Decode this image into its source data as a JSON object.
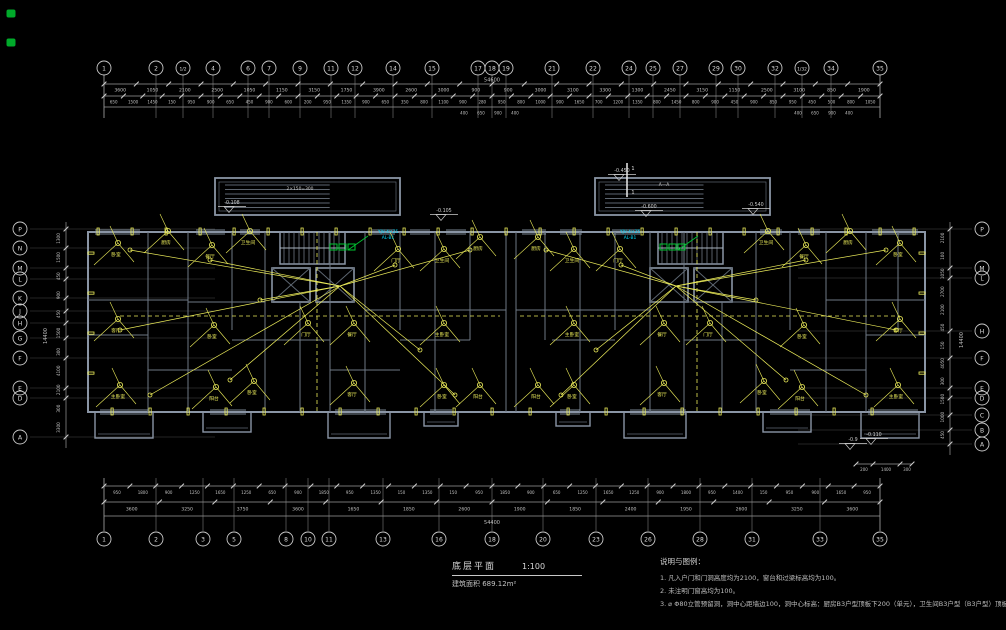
{
  "drawing": {
    "title": "底层平面",
    "scale": "1:100",
    "area_note": "建筑面积 689.12m²",
    "total_dim_top": "54600",
    "total_dim_bottom": "54400",
    "total_dim_left": "14400",
    "total_dim_right": "14400",
    "grid": {
      "top": [
        {
          "x": 104,
          "label": "1"
        },
        {
          "x": 156,
          "label": "2"
        },
        {
          "x": 183,
          "label": "1/2"
        },
        {
          "x": 213,
          "label": "4"
        },
        {
          "x": 248,
          "label": "6"
        },
        {
          "x": 269,
          "label": "7"
        },
        {
          "x": 300,
          "label": "9"
        },
        {
          "x": 331,
          "label": "11"
        },
        {
          "x": 355,
          "label": "12"
        },
        {
          "x": 393,
          "label": "14"
        },
        {
          "x": 432,
          "label": "15"
        },
        {
          "x": 478,
          "label": "17"
        },
        {
          "x": 492,
          "label": "18"
        },
        {
          "x": 506,
          "label": "19"
        },
        {
          "x": 552,
          "label": "21"
        },
        {
          "x": 593,
          "label": "22"
        },
        {
          "x": 629,
          "label": "24"
        },
        {
          "x": 653,
          "label": "25"
        },
        {
          "x": 680,
          "label": "27"
        },
        {
          "x": 716,
          "label": "29"
        },
        {
          "x": 738,
          "label": "30"
        },
        {
          "x": 775,
          "label": "32"
        },
        {
          "x": 802,
          "label": "1/32"
        },
        {
          "x": 831,
          "label": "34"
        },
        {
          "x": 880,
          "label": "35"
        }
      ],
      "bottom": [
        {
          "x": 104,
          "label": "1"
        },
        {
          "x": 156,
          "label": "2"
        },
        {
          "x": 203,
          "label": "3"
        },
        {
          "x": 234,
          "label": "5"
        },
        {
          "x": 286,
          "label": "8"
        },
        {
          "x": 308,
          "label": "10"
        },
        {
          "x": 329,
          "label": "11"
        },
        {
          "x": 383,
          "label": "13"
        },
        {
          "x": 439,
          "label": "16"
        },
        {
          "x": 492,
          "label": "18"
        },
        {
          "x": 543,
          "label": "20"
        },
        {
          "x": 596,
          "label": "23"
        },
        {
          "x": 648,
          "label": "26"
        },
        {
          "x": 700,
          "label": "28"
        },
        {
          "x": 752,
          "label": "31"
        },
        {
          "x": 820,
          "label": "33"
        },
        {
          "x": 880,
          "label": "35"
        }
      ],
      "left": [
        {
          "y": 229,
          "label": "P"
        },
        {
          "y": 248,
          "label": "N"
        },
        {
          "y": 268,
          "label": "M"
        },
        {
          "y": 279,
          "label": "L"
        },
        {
          "y": 298,
          "label": "K"
        },
        {
          "y": 311,
          "label": "J"
        },
        {
          "y": 323,
          "label": "H"
        },
        {
          "y": 338,
          "label": "G"
        },
        {
          "y": 358,
          "label": "F"
        },
        {
          "y": 388,
          "label": "E"
        },
        {
          "y": 398,
          "label": "D"
        },
        {
          "y": 437,
          "label": "A"
        }
      ],
      "right": [
        {
          "y": 229,
          "label": "P"
        },
        {
          "y": 268,
          "label": "M"
        },
        {
          "y": 278,
          "label": "L"
        },
        {
          "y": 331,
          "label": "H"
        },
        {
          "y": 358,
          "label": "F"
        },
        {
          "y": 388,
          "label": "E"
        },
        {
          "y": 398,
          "label": "D"
        },
        {
          "y": 415,
          "label": "C"
        },
        {
          "y": 430,
          "label": "B"
        },
        {
          "y": 444,
          "label": "A"
        }
      ]
    },
    "dims": {
      "top_major": [
        3600,
        1050,
        2100,
        2500,
        1050,
        1150,
        3150,
        1750,
        3900,
        2600,
        3000,
        900,
        900,
        3000,
        3100,
        3300,
        1300,
        2450,
        3150,
        1150,
        2500,
        3100,
        850,
        1900
      ],
      "top_minor": [
        650,
        1500,
        1450,
        150,
        950,
        900,
        650,
        450,
        900,
        600,
        200,
        950,
        1350,
        900,
        650,
        350,
        800,
        1100,
        900,
        280,
        950,
        800,
        1000,
        900,
        1650,
        700,
        1200,
        1350,
        800,
        1450,
        800,
        900,
        450,
        900,
        850,
        950,
        450,
        500,
        800,
        1050
      ],
      "top_extra": [
        400,
        650,
        900,
        400
      ],
      "bottom_major": [
        3600,
        3250,
        3750,
        3600,
        1650,
        1850,
        2600,
        1900,
        1850,
        2400,
        1950,
        2600,
        3250,
        3600
      ],
      "bottom_minor": [
        950,
        1800,
        900,
        1250,
        1650,
        1250,
        650,
        900,
        1850,
        950,
        1350,
        150,
        1350,
        150,
        950,
        1850,
        900,
        650,
        1250,
        1650,
        1250,
        900,
        1800,
        950,
        1400,
        150,
        950,
        900,
        1650,
        950
      ],
      "left": [
        1300,
        1500,
        450,
        900,
        450,
        1500,
        300,
        4100,
        2100,
        300,
        3300
      ],
      "right": [
        2100,
        100,
        1050,
        2700,
        2100,
        450,
        150,
        4050,
        300,
        1500,
        1000,
        450
      ],
      "porch": [
        200,
        1400,
        300
      ]
    },
    "rooms": [
      {
        "x": 116,
        "y": 256,
        "label": "卧室"
      },
      {
        "x": 116,
        "y": 332,
        "label": "客厅"
      },
      {
        "x": 118,
        "y": 398,
        "label": "主卧室"
      },
      {
        "x": 166,
        "y": 244,
        "label": "厨房"
      },
      {
        "x": 210,
        "y": 258,
        "label": "餐厅"
      },
      {
        "x": 212,
        "y": 338,
        "label": "卧室"
      },
      {
        "x": 214,
        "y": 400,
        "label": "阳台"
      },
      {
        "x": 248,
        "y": 244,
        "label": "卫生间"
      },
      {
        "x": 252,
        "y": 394,
        "label": "卧室"
      },
      {
        "x": 306,
        "y": 336,
        "label": "门厅"
      },
      {
        "x": 352,
        "y": 396,
        "label": "客厅"
      },
      {
        "x": 352,
        "y": 336,
        "label": "餐厅"
      },
      {
        "x": 396,
        "y": 262,
        "label": "门厅"
      },
      {
        "x": 442,
        "y": 262,
        "label": "卫生间"
      },
      {
        "x": 478,
        "y": 250,
        "label": "厨房"
      },
      {
        "x": 442,
        "y": 336,
        "label": "主卧室"
      },
      {
        "x": 478,
        "y": 398,
        "label": "阳台"
      },
      {
        "x": 442,
        "y": 398,
        "label": "卧室"
      },
      {
        "x": 898,
        "y": 256,
        "label": "卧室"
      },
      {
        "x": 898,
        "y": 332,
        "label": "客厅"
      },
      {
        "x": 896,
        "y": 398,
        "label": "主卧室"
      },
      {
        "x": 848,
        "y": 244,
        "label": "厨房"
      },
      {
        "x": 804,
        "y": 258,
        "label": "餐厅"
      },
      {
        "x": 802,
        "y": 338,
        "label": "卧室"
      },
      {
        "x": 800,
        "y": 400,
        "label": "阳台"
      },
      {
        "x": 766,
        "y": 244,
        "label": "卫生间"
      },
      {
        "x": 762,
        "y": 394,
        "label": "卧室"
      },
      {
        "x": 708,
        "y": 336,
        "label": "门厅"
      },
      {
        "x": 662,
        "y": 396,
        "label": "客厅"
      },
      {
        "x": 662,
        "y": 336,
        "label": "餐厅"
      },
      {
        "x": 618,
        "y": 262,
        "label": "门厅"
      },
      {
        "x": 572,
        "y": 262,
        "label": "卫生间"
      },
      {
        "x": 536,
        "y": 250,
        "label": "厨房"
      },
      {
        "x": 572,
        "y": 336,
        "label": "主卧室"
      },
      {
        "x": 536,
        "y": 398,
        "label": "阳台"
      },
      {
        "x": 572,
        "y": 398,
        "label": "卧室"
      }
    ],
    "panel_labels": [
      {
        "x": 388,
        "y": 233,
        "l1": "YJV-4×25",
        "l2": "AL-B1"
      },
      {
        "x": 630,
        "y": 233,
        "l1": "YJV-4×25",
        "l2": "AL-B1"
      }
    ],
    "levels": [
      {
        "x": 224,
        "y": 204,
        "v": "-0.108"
      },
      {
        "x": 614,
        "y": 172,
        "v": "-0.450"
      },
      {
        "x": 641,
        "y": 208,
        "v": "-0.600"
      },
      {
        "x": 748,
        "y": 206,
        "v": "-0.540"
      },
      {
        "x": 436,
        "y": 212,
        "v": "-0.105"
      },
      {
        "x": 866,
        "y": 436,
        "v": "-0.110"
      },
      {
        "x": 845,
        "y": 441,
        "v": "-0.9"
      }
    ],
    "canopy_notes": [
      {
        "x": 300,
        "y": 190,
        "v": "2×150=300"
      },
      {
        "x": 664,
        "y": 186,
        "v": "A—A"
      }
    ],
    "section_label": "1",
    "notes": {
      "title": "说明与图例：",
      "items": [
        "1. 凡入户门和门洞高度均为2100，窗台和过梁标高均为100。",
        "2. 未注明门窗高均为100。",
        "3. ⌀   Φ80立管预留洞，洞中心距墙边100，洞中心标高：厨房B3户型顶板下200（单元），卫生间B3户型（B3户型）顶板下220。"
      ]
    }
  },
  "colors": {
    "wall": "#8a95a5",
    "wall_dim": "#5f6974",
    "wire": "#ecec5a",
    "cyan": "#00dcff",
    "green": "#00c832",
    "dim_text": "#c0c0c0",
    "grid_line": "#6a6a6a",
    "bubble": "#c8c8c8"
  }
}
